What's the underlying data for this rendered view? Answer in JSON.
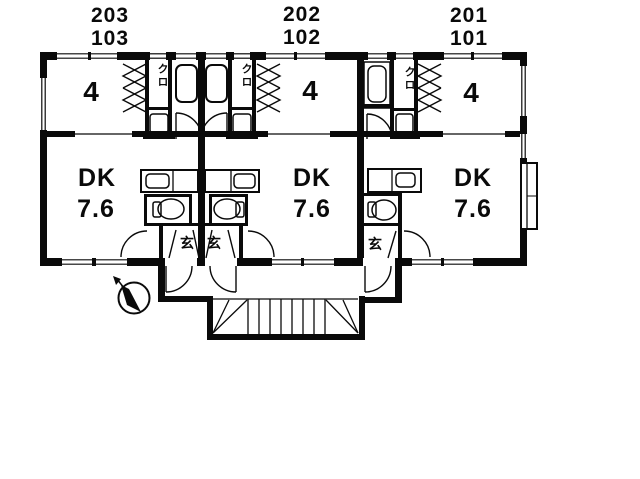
{
  "colors": {
    "line": "#000000",
    "background": "#ffffff"
  },
  "units": [
    {
      "floor2_number": "203",
      "floor1_number": "103",
      "tatami_room": "4",
      "dk_label": "DK",
      "dk_area": "7.6",
      "closet": "クロ",
      "entrance": "玄"
    },
    {
      "floor2_number": "202",
      "floor1_number": "102",
      "tatami_room": "4",
      "dk_label": "DK",
      "dk_area": "7.6",
      "closet": "クロ",
      "entrance": "玄"
    },
    {
      "floor2_number": "201",
      "floor1_number": "101",
      "tatami_room": "4",
      "dk_label": "DK",
      "dk_area": "7.6",
      "closet": "クロ",
      "entrance": "玄"
    }
  ],
  "icons": {
    "compass": "north-arrow",
    "stairs": "staircase"
  }
}
